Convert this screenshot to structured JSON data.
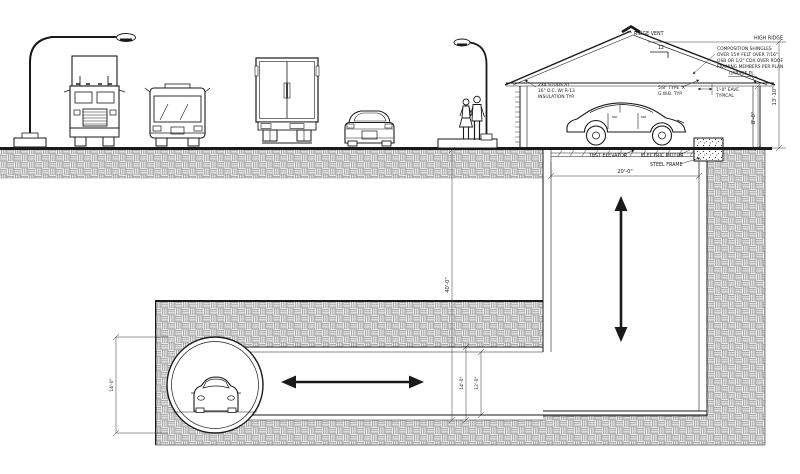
{
  "drawing": {
    "labels": {
      "ridge_vent": "RIDGE VENT",
      "high_ridge": "HIGH RIDGE",
      "roof_pitch_run": "12",
      "garage_plate": "GARAGE PL.",
      "test_elevator": "TEST ELEVATOR",
      "electric_motor": "ELECTRIC MOTOR",
      "steel_frame": "STEEL FRAME"
    },
    "notes": {
      "shingles": [
        "COMPOSITION SHINGLES",
        "OVER 15# FELT OVER 7/16\"",
        "OSB OR 1/2\" CDX OVER ROOF",
        "FRAMING MEMBERS PER PLAN"
      ],
      "gwb": [
        "5/8\" TYPE 'X'",
        "G.W.B. TYP."
      ],
      "eave": [
        "1'-0\" EAVE",
        "TYPICAL"
      ],
      "studs": [
        "2X4 STUDS AT",
        "16\" O.C. W/ R-13",
        "INSULATION TYP."
      ]
    },
    "dimensions": {
      "shaft_width": "20'-0\"",
      "ridge_height": "13'-10\"",
      "plate_height": "8'-0\"",
      "shaft_depth": "40'-0\"",
      "tunnel_outer": "14'-0\"",
      "tunnel_inner": "12'-0\"",
      "bore_diameter": "14'-0\""
    },
    "colors": {
      "line": "#1a1a1a",
      "hatch": "#777777",
      "background": "#ffffff"
    }
  }
}
